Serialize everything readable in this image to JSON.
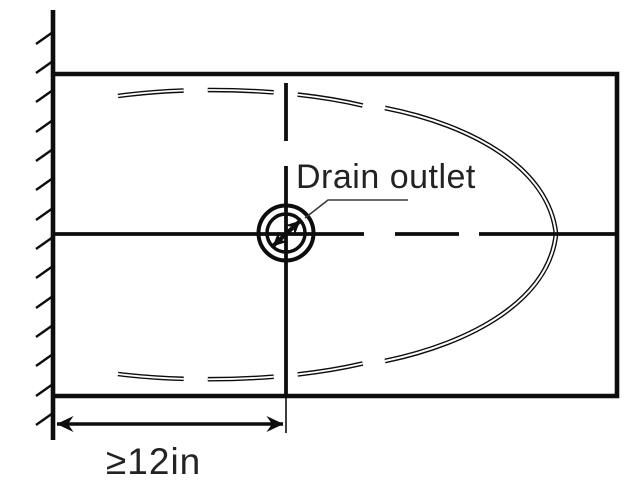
{
  "diagram": {
    "type": "technical-plan-diagram",
    "subject": "drain-outlet-location",
    "labels": {
      "drain_outlet": "Drain outlet",
      "min_distance": "≥12in"
    },
    "colors": {
      "line": "#0d0d0d",
      "text": "#232323",
      "background": "#ffffff"
    },
    "symbols": [
      "wall-hatch-icon",
      "drain-symbol-icon",
      "centerline",
      "dimension-arrow-icon",
      "leader-line"
    ],
    "dimension": {
      "value": "≥12in",
      "measured_from": "wall",
      "measured_to": "drain-centerline"
    }
  }
}
